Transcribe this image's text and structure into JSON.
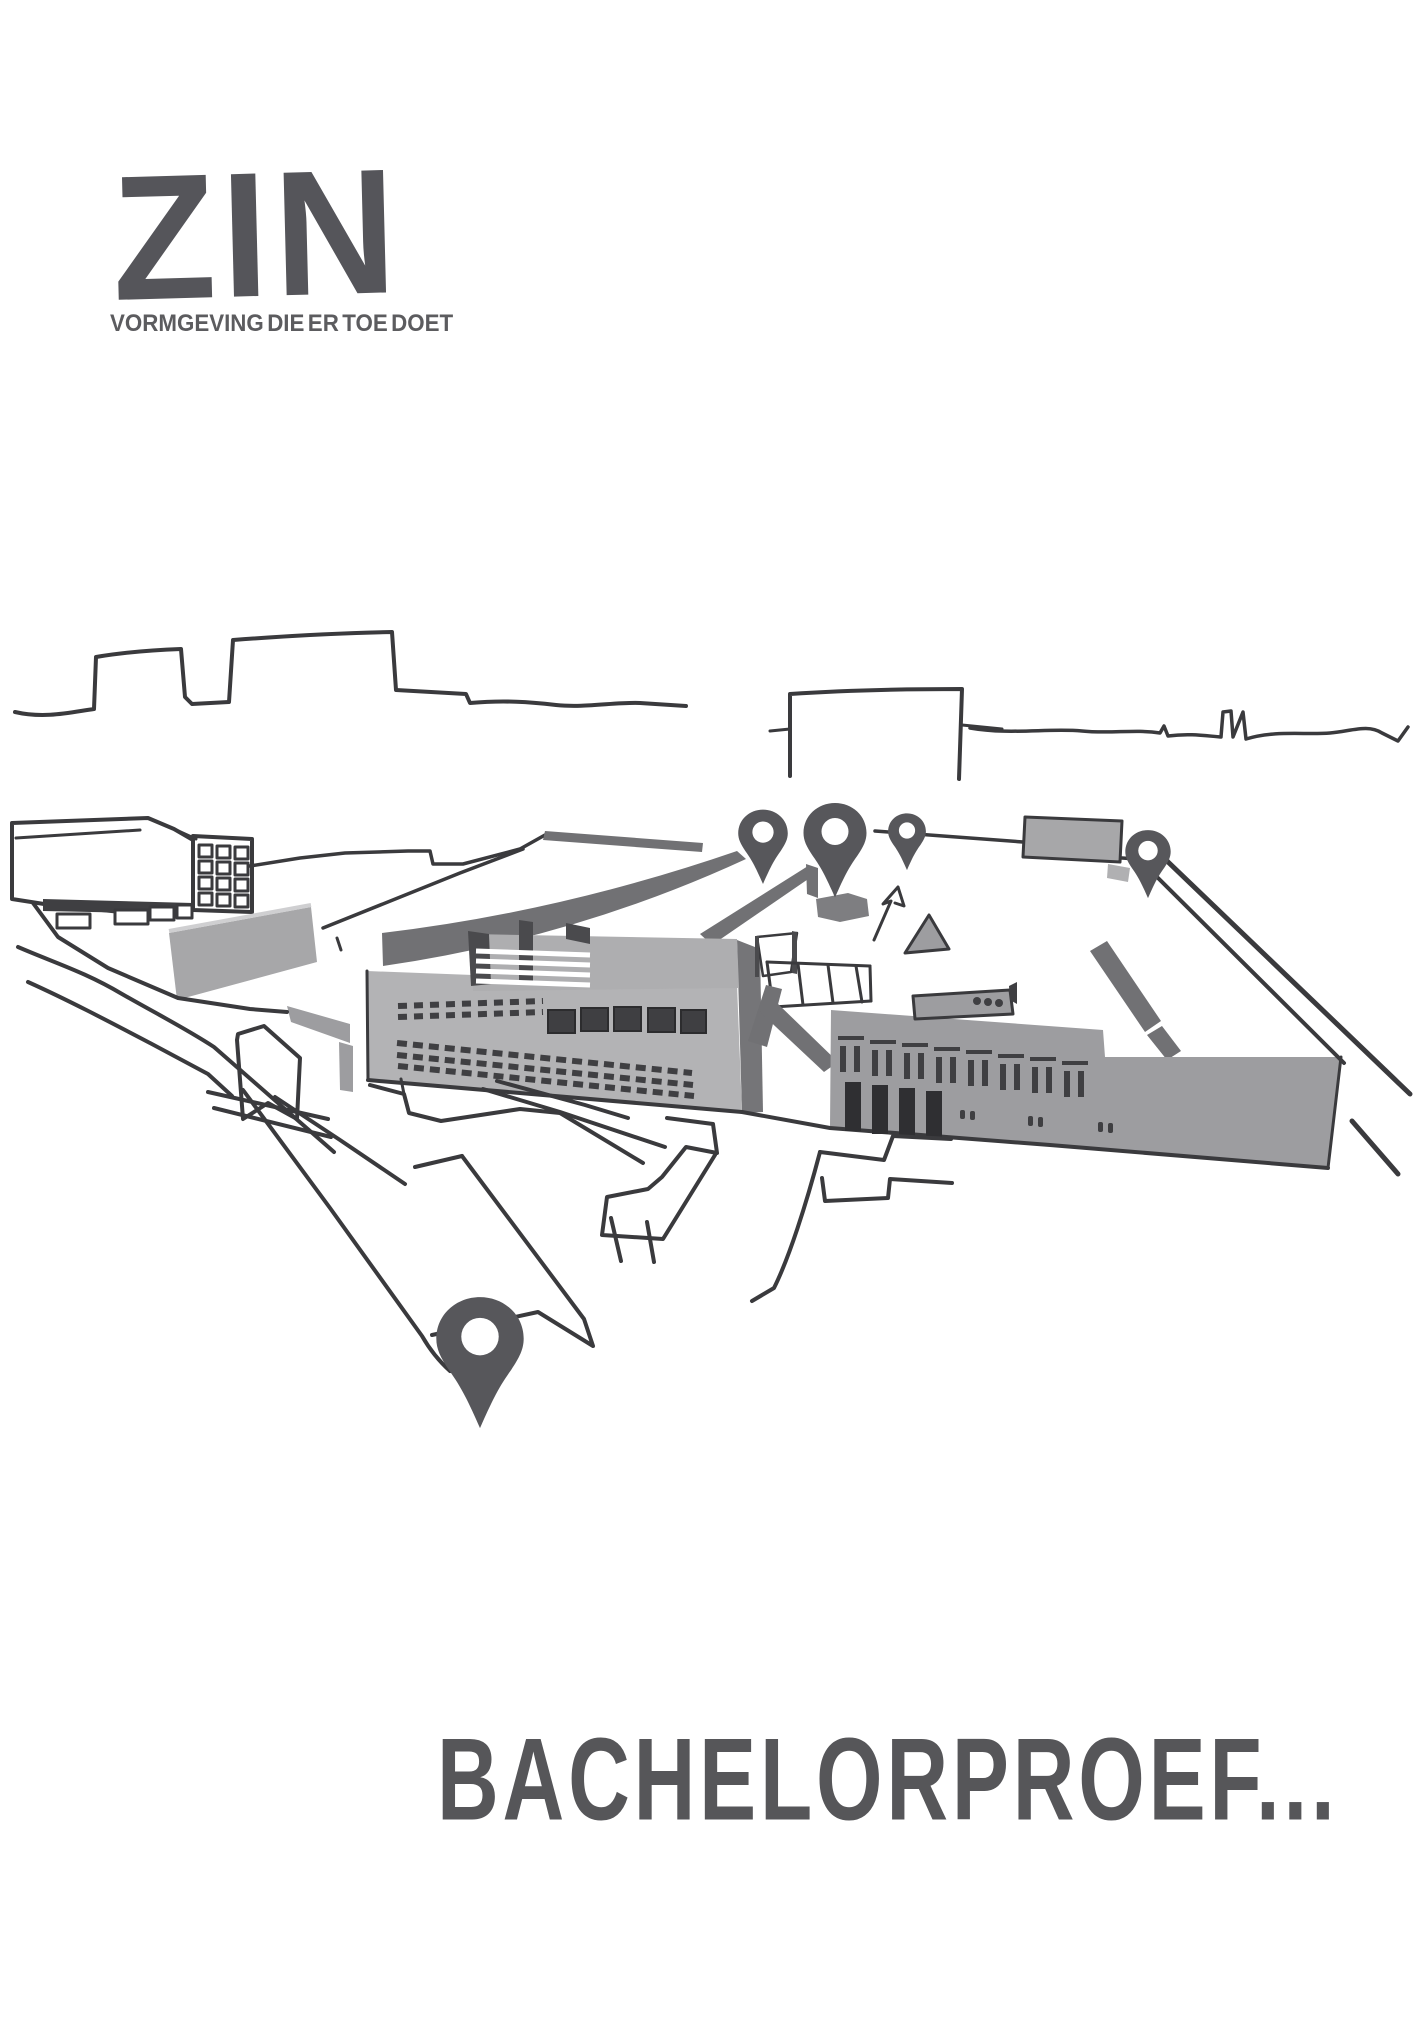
{
  "page": {
    "background": "#ffffff"
  },
  "logo": {
    "text": "ZIN",
    "tagline": "VORMGEVING DIE ER TOE DOET",
    "color": "#55555a",
    "tagline_color": "#5c5c5f"
  },
  "title": {
    "text": "BACHELORPROEF...",
    "color": "#565659"
  },
  "illustration": {
    "description": "Hand-drawn aerial sketch of a school campus site with city skyline and map location pins",
    "ink_color": "#3a3a3d",
    "building_gray_light": "#b3b3b5",
    "building_gray_mid": "#9d9da0",
    "roof_gray_dark": "#717174",
    "window_dark": "#3f3f42",
    "pin_color": "#57575b",
    "pins": [
      {
        "name": "map-pin-roof-west-icon",
        "x": 763,
        "y": 838,
        "scale": 0.59
      },
      {
        "name": "map-pin-roof-center-icon",
        "x": 835,
        "y": 839,
        "scale": 0.75
      },
      {
        "name": "map-pin-roof-east-icon",
        "x": 907,
        "y": 835,
        "scale": 0.45
      },
      {
        "name": "map-pin-far-east-icon",
        "x": 1148,
        "y": 856,
        "scale": 0.54
      },
      {
        "name": "map-pin-foreground-icon",
        "x": 480,
        "y": 1347,
        "scale": 1.04
      }
    ]
  }
}
